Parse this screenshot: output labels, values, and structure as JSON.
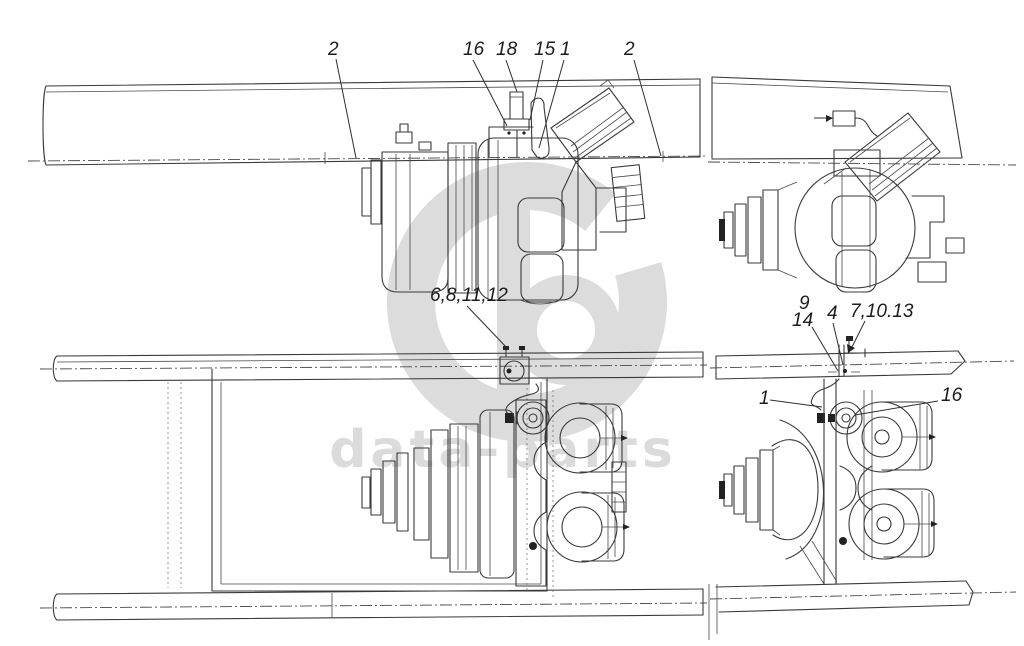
{
  "watermark": {
    "text": "data-parts",
    "color": "#dbdbdb"
  },
  "drawing": {
    "line_color": "#3a3a3a",
    "background": "#ffffff"
  },
  "callouts": [
    {
      "id": "c2-left",
      "label": "2"
    },
    {
      "id": "c16-top",
      "label": "16"
    },
    {
      "id": "c18",
      "label": "18"
    },
    {
      "id": "c15",
      "label": "15"
    },
    {
      "id": "c1-top",
      "label": "1"
    },
    {
      "id": "c2-right",
      "label": "2"
    },
    {
      "id": "c6-8-11-12",
      "label": "6,8,11,12"
    },
    {
      "id": "c9",
      "label": "9"
    },
    {
      "id": "c14",
      "label": "14"
    },
    {
      "id": "c4",
      "label": "4"
    },
    {
      "id": "c7-10-13",
      "label": "7,10.13"
    },
    {
      "id": "c1-bottom",
      "label": "1"
    },
    {
      "id": "c16-bottom",
      "label": "16"
    }
  ]
}
